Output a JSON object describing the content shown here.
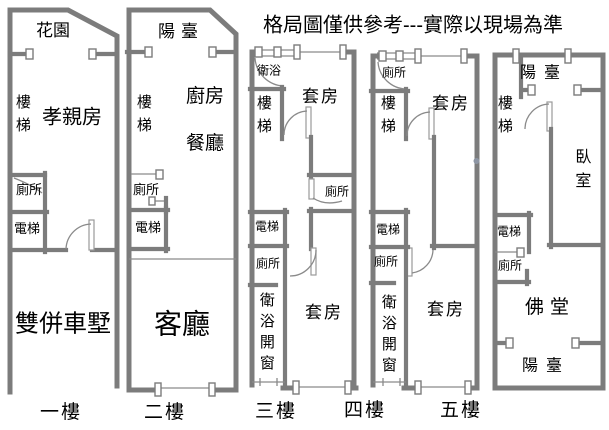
{
  "title": "格局圖僅供參考---實際以現場為準",
  "colors": {
    "wall": "#7c7c7c",
    "text": "#000000",
    "background": "#ffffff"
  },
  "floors": [
    {
      "label": "一樓",
      "rooms": {
        "garden": "花園",
        "stairs": "樓梯",
        "parents": "孝親房",
        "toilet": "廁所",
        "elevator": "電梯",
        "garage": "雙併車墅"
      }
    },
    {
      "label": "二樓",
      "rooms": {
        "balcony": "陽臺",
        "stairs": "樓梯",
        "kitchen": "廚房",
        "dining": "餐廳",
        "toilet": "廁所",
        "elevator": "電梯",
        "living": "客廳"
      }
    },
    {
      "label": "三樓",
      "rooms": {
        "bath": "衛浴",
        "stairs": "樓梯",
        "suiteTop": "套房",
        "toiletMid": "廁所",
        "elevator": "電梯",
        "toilet": "廁所",
        "bathWindow": "衛浴開窗",
        "suiteBottom": "套房"
      }
    },
    {
      "label": "四樓",
      "rooms": {
        "toiletTop": "廁所",
        "stairs": "樓梯",
        "suiteTop": "套房",
        "elevator": "電梯",
        "toilet": "廁所",
        "bathWindow": "衛浴開窗",
        "suiteBottom": "套房"
      }
    },
    {
      "label": "五樓",
      "rooms": {
        "balconyTop": "陽臺",
        "stairs": "樓梯",
        "bedroom": "臥室",
        "elevator": "電梯",
        "toilet": "廁所",
        "buddhaHall": "佛堂",
        "balconyBottom": "陽臺"
      }
    }
  ]
}
